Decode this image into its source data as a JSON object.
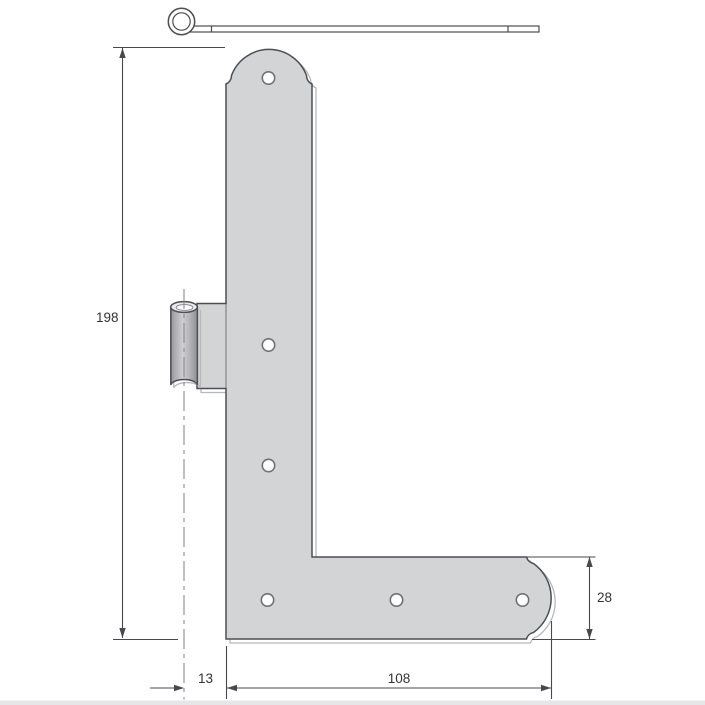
{
  "drawing": {
    "dimension_labels": {
      "plate_height": "198",
      "pin_offset": "13",
      "strap_length": "108",
      "strap_width": "28"
    },
    "parts": {
      "pin_side_view": "hinge-pin-side-view",
      "plate": "l-shaped-hinge-plate",
      "barrel": "hinge-knuckle-barrel",
      "holes": "screw-holes",
      "hole_count": 6
    },
    "colors": {
      "plate_fill": "#d3d4d6",
      "barrel_top_fill": "#e9e9eb",
      "outline": "#4d4e52",
      "shadow": "#b7b8bc",
      "dimension_line": "#48494d",
      "label_text": "#333333",
      "background": "#ffffff"
    }
  }
}
